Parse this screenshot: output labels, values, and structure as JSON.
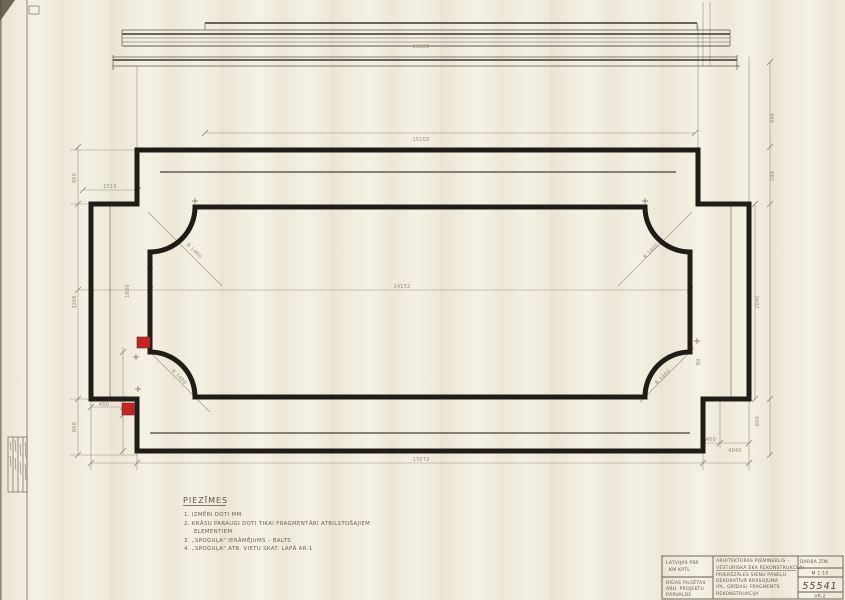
{
  "colors": {
    "ink": "#201d18",
    "pencil": "#7b7261",
    "faint": "#9a9180",
    "red": "#c22524",
    "paper": "#f1edde"
  },
  "dims": {
    "elevation_length": "16320",
    "plan_top": "15102",
    "left_jog": "1515",
    "mid_width": "14152",
    "overall_width": "17072",
    "left_upper": "950",
    "left_wing": "3265",
    "left_lower": "860",
    "left_mid_offset": "1800",
    "sample_offset_left": "450",
    "right_small_1": "450",
    "right_small_2": "4040",
    "right_lower": "600",
    "right_top_1": "448",
    "right_top_2": "298",
    "right_wing": "2040",
    "corner_offset": "90",
    "radius_tl": "R 1400",
    "radius_tr": "R 1400",
    "radius_bl": "R 1400",
    "radius_br": "R 1400"
  },
  "notes": {
    "title": "PIEZĪMES",
    "items": [
      "1. IZMĒRI DOTI MM",
      "2. KRĀSU PARAUGI DOTI TIKAI FRAGMENTĀRI ATBILSTOŠAJIEM",
      "ELEMENTIEM",
      "3. „SPOGUĻA\" IERĀMĒJUMS – BALTS",
      "4. „SPOGUĻA\" ATR. VIETU SKAT. LAPĀ AR-1"
    ]
  },
  "title_block": {
    "org_top": [
      "LATVIJAS PSR",
      "KM KPTL"
    ],
    "org_bottom": [
      "RĪGAS PILSĒTAS",
      "ARH. PROJEKTU",
      "PĀRVALDE"
    ],
    "project_lines": [
      "ARHITEKTŪRAS PIEMINEKLIS –",
      "VĒSTURISKĀ ĒKA REKONSTRUKCIJAI",
      "PRIEKŠZĀLES SIENU PANEĻU",
      "DEKORATĪVĀ KRĀSOJUMA",
      "(PL. GRĪDAS) FRAGMENTS",
      "REKONSTRUKCIJA"
    ],
    "doc_label": "DARBA ZĪM.",
    "scale": "M 1:10",
    "number": "55541",
    "sheet": "AR-2"
  }
}
